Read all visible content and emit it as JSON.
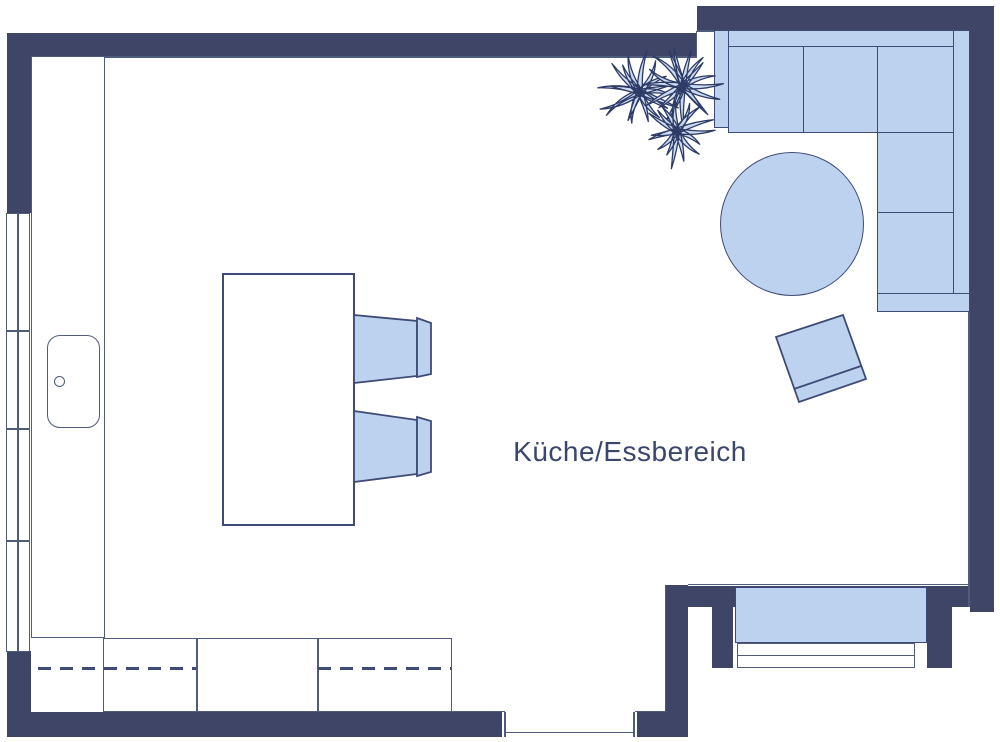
{
  "room": {
    "label": "Küche/Essbereich"
  },
  "colors": {
    "wall": "#3e4566",
    "fill": "#bdd2ee",
    "stroke": "#3f4b77",
    "outline": "#505c7c",
    "text": "#3a466b",
    "plant_fill": "#cbdaf3",
    "plant_stroke": "#2e3b66",
    "floor": "#ffffff"
  }
}
